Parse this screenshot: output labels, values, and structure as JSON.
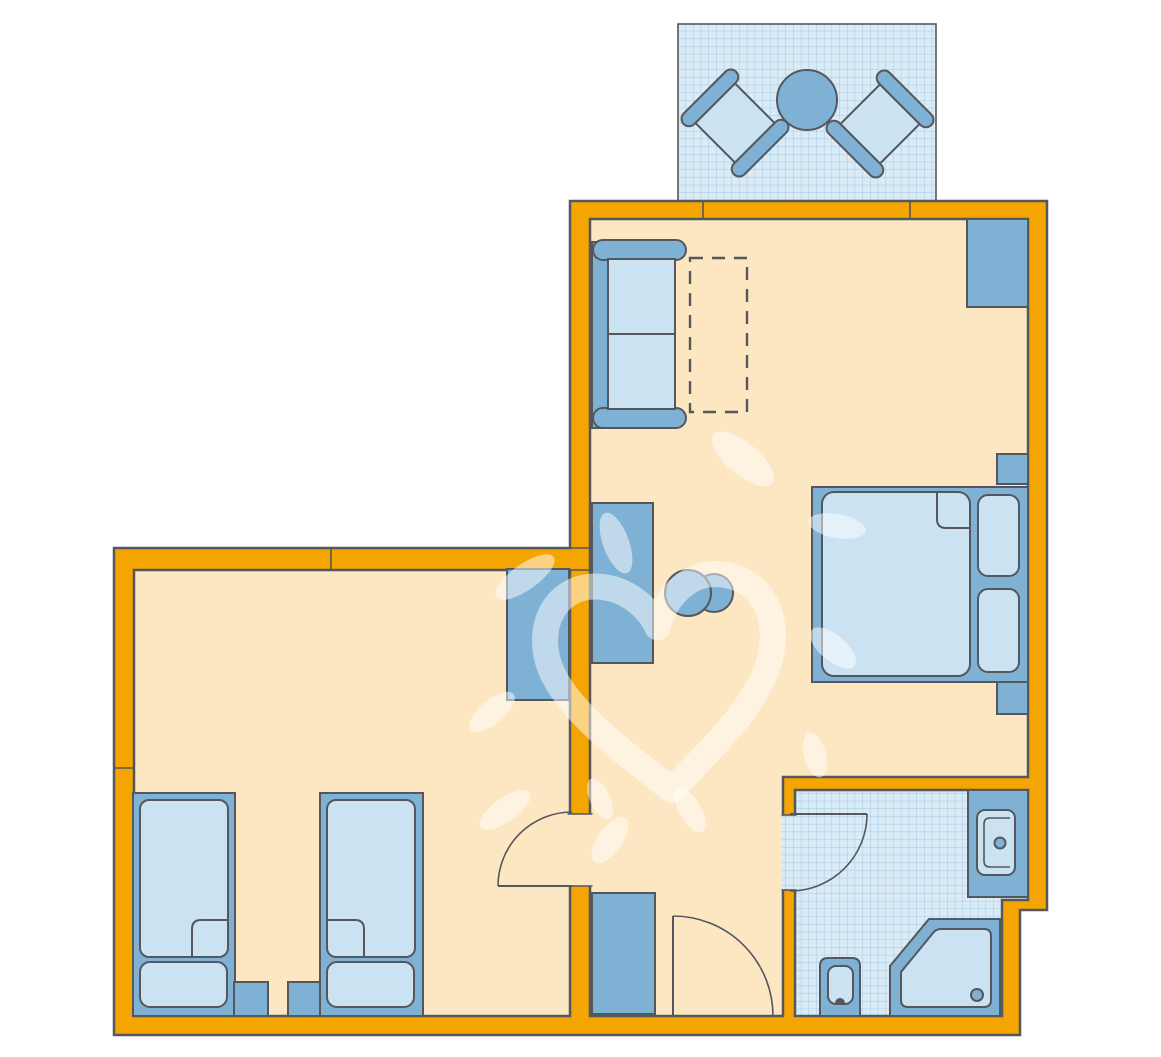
{
  "title": "apartment-floor-plan",
  "colors": {
    "background": "#FFFFFF",
    "wall": "#F5A502",
    "outline": "#54575C",
    "floor": "#FCE7C2",
    "tile": "#D8EBF7",
    "tile_grid": "#A6C9E2",
    "furniture": "#7FB1D5",
    "furniture_light": "#CBE2F3",
    "watermark": "#FFFFFF"
  },
  "elements": {
    "balcony": [
      "balcony-terrace",
      "patio-chair-left",
      "patio-chair-right",
      "patio-table"
    ],
    "living_room": [
      "sofa",
      "optional-table-dashed",
      "wardrobe",
      "double-bed",
      "pillows",
      "nightstands",
      "desk",
      "stools"
    ],
    "left_room": [
      "wardrobe",
      "single-bed-1",
      "single-bed-2",
      "nightstands"
    ],
    "hall": [
      "hall-cabinet",
      "entrance-door"
    ],
    "bathroom": [
      "sink-vanity",
      "toilet",
      "corner-shower",
      "bathroom-door"
    ],
    "watermark": [
      "heart-watermark",
      "brush-blobs"
    ]
  }
}
